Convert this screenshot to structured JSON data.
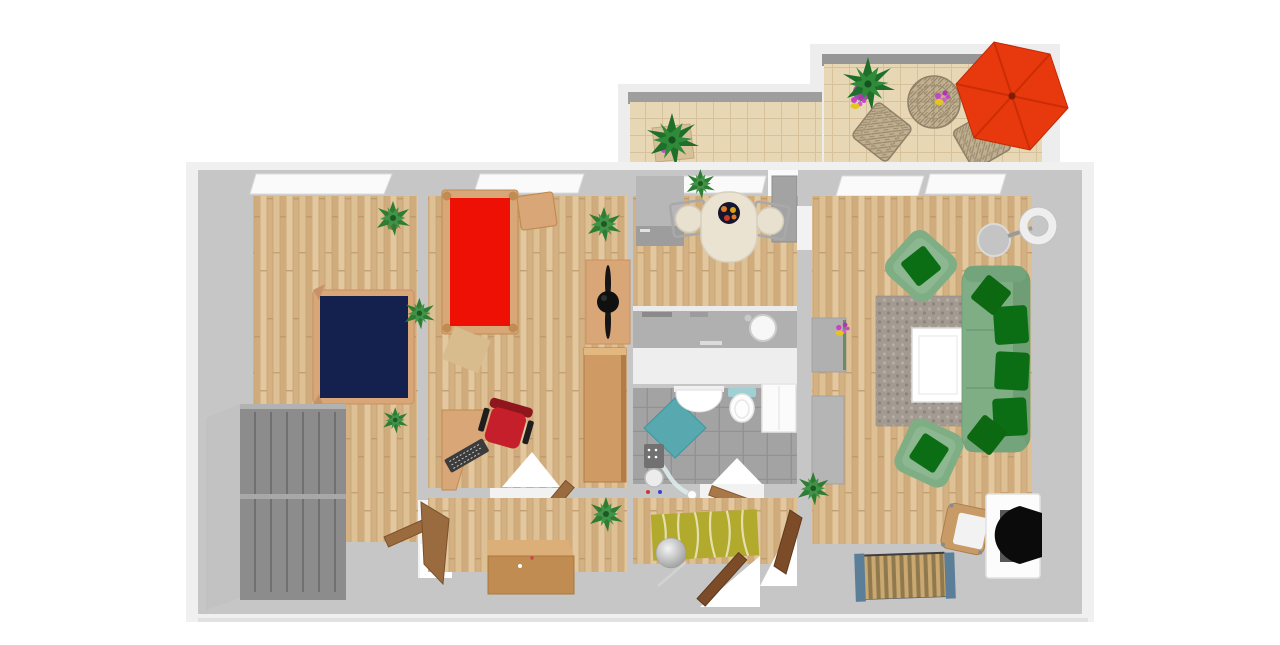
{
  "scene": {
    "type": "3d-floorplan-top-down-render",
    "description": "Top-down 3D rendering of a two-bedroom apartment with balcony, no visible text labels",
    "width_px": 1280,
    "height_px": 645
  },
  "colors": {
    "background": "#ffffff",
    "wall_outer": "#f0f0f0",
    "wall_inner": "#c6c6c6",
    "wood_floor": "#d9b98c",
    "balcony_tile": "#e8d7b4",
    "bathroom_tile": "#a3a3a3",
    "bed_double_mattress": "#14204e",
    "bed_single_mattress": "#ee1005",
    "bed_frame": "#d9a677",
    "sofa_body": "#7fae85",
    "sofa_cushion": "#0c6e14",
    "office_chair": "#c41f2a",
    "wardrobe_front": "#8c8c8c",
    "rug_hall": "#b1aa2c",
    "rug_living": "#a39a92",
    "shower": "#58a8b0",
    "umbrella": "#e8380d",
    "door_wood": "#9a6b3f",
    "entry_door_wood": "#7c4c28",
    "plant_green": "#2f7d33",
    "flower_pink": "#c943c9",
    "flower_yellow": "#e2c71f"
  },
  "rooms": [
    {
      "id": "bedroom",
      "name": "Bedroom (left)",
      "floor": "wood",
      "furniture": [
        "double-bed-navy",
        "gray-wardrobe",
        "potted-plant",
        "interior-door"
      ]
    },
    {
      "id": "kids-room",
      "name": "Second bedroom / office",
      "floor": "wood",
      "furniture": [
        "single-bed-red",
        "bedside-table",
        "corner-desk",
        "keyboard",
        "office-chair-red",
        "fan-sideboard",
        "bookcase",
        "potted-plant",
        "plant-on-mat",
        "interior-door"
      ]
    },
    {
      "id": "kitchen",
      "name": "Kitchen",
      "floor": "wood",
      "furniture": [
        "tall-fridge",
        "dining-table",
        "fruit-bowl",
        "dining-chair-left",
        "dining-chair-right",
        "counter-with-sink",
        "open-balcony-door"
      ]
    },
    {
      "id": "bathroom",
      "name": "Bathroom",
      "floor": "gray-tile",
      "furniture": [
        "washbasin",
        "toilet",
        "corner-shower",
        "shower-fixture",
        "bath-cabinet",
        "interior-door"
      ]
    },
    {
      "id": "hallway",
      "name": "Hallway",
      "floor": "wood",
      "furniture": [
        "striped-rug-yellow-green",
        "coat-stand",
        "entry-door",
        "living-room-door"
      ]
    },
    {
      "id": "storage",
      "name": "Lower middle room",
      "floor": "wood",
      "furniture": [
        "wooden-chest",
        "chest-plant",
        "corner-plant",
        "interior-door"
      ]
    },
    {
      "id": "living",
      "name": "Living room",
      "floor": "wood",
      "furniture": [
        "green-sofa-3-cushions-2-pillows",
        "green-armchair-top",
        "green-armchair-bottom",
        "shag-rug",
        "white-coffee-table",
        "flower-vase",
        "floor-lamp",
        "wall-cabinet-upper",
        "wall-cabinet-lower",
        "computer-desk",
        "crt-monitor",
        "pc-tower",
        "desk-chair",
        "slatted-rack",
        "potted-plant-top",
        "potted-plant-bottom"
      ]
    },
    {
      "id": "balcony",
      "name": "Balcony / terrace",
      "floor": "beige-tile",
      "furniture": [
        "palm-plant-left",
        "palm-plant-purple-pot",
        "wicker-table",
        "table-flowers",
        "wicker-chair-left",
        "wicker-chair-right",
        "red-parasol"
      ]
    }
  ],
  "counts": {
    "windows_top_wall": 5,
    "sofa_seat_cushions": 3,
    "sofa_pillows": 2,
    "balcony_chairs": 2
  }
}
